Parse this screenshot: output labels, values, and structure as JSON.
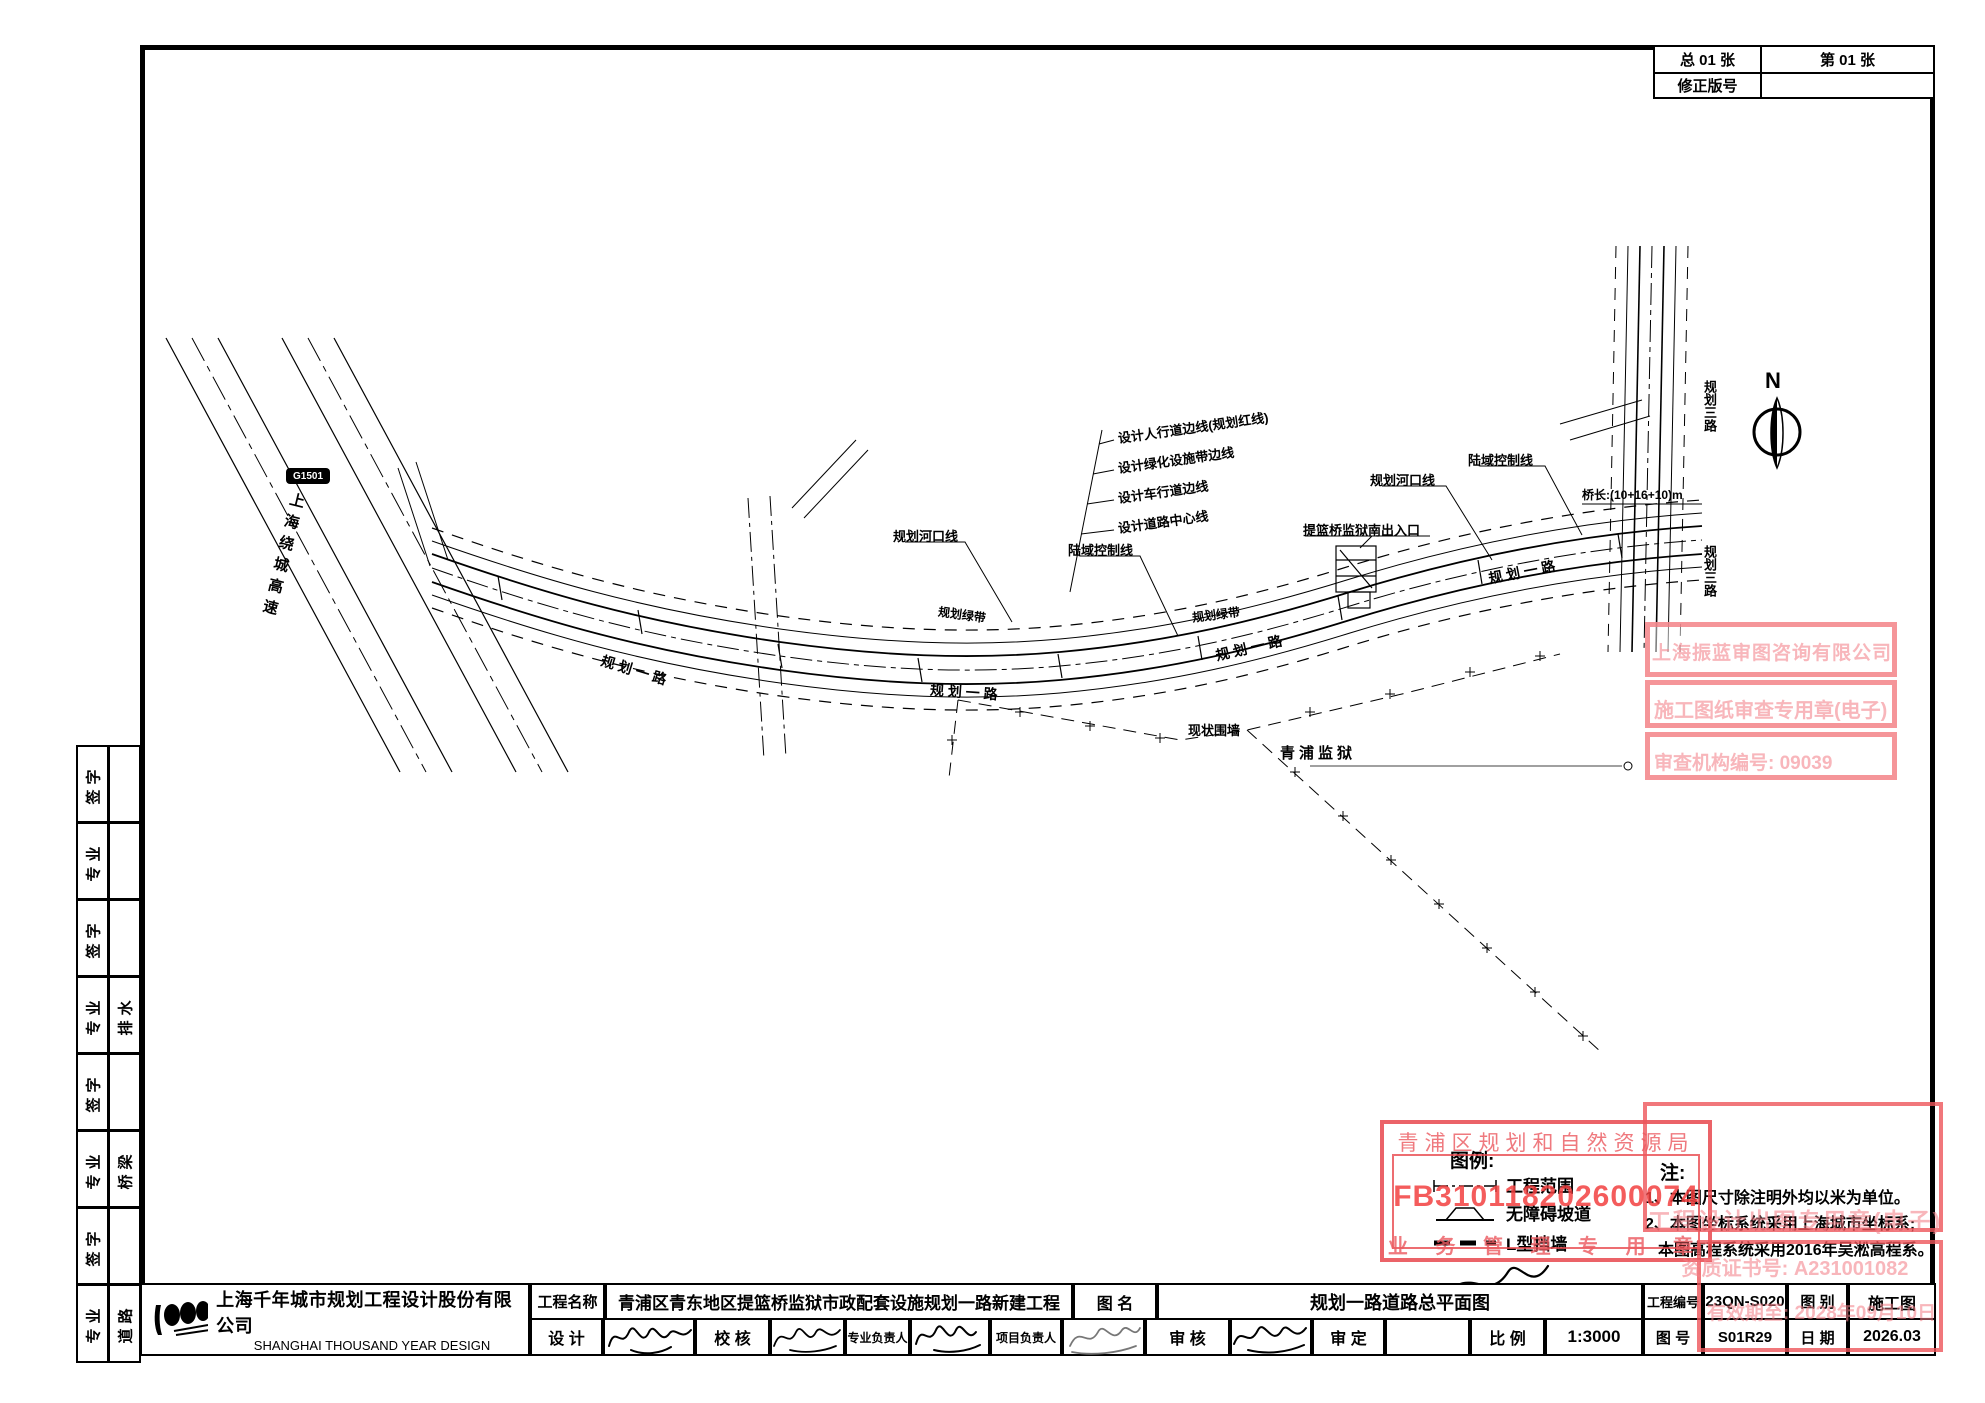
{
  "header": {
    "total_pages": "总 01 张",
    "page_no": "第 01 张",
    "revision_label": "修正版号",
    "revision_value": ""
  },
  "sidebar": {
    "rows": [
      {
        "label": "签字",
        "value": ""
      },
      {
        "label": "专业",
        "value": ""
      },
      {
        "label": "签字",
        "value": ""
      },
      {
        "label": "专业",
        "value": "排水"
      },
      {
        "label": "签字",
        "value": ""
      },
      {
        "label": "专业",
        "value": "桥梁"
      },
      {
        "label": "签字",
        "value": ""
      },
      {
        "label": "专业",
        "value": "道路"
      }
    ]
  },
  "title_block": {
    "company_cn": "上海千年城市规划工程设计股份有限公司",
    "company_en": "SHANGHAI THOUSAND YEAR DESIGN",
    "project_label": "工程名称",
    "project_name": "青浦区青东地区提篮桥监狱市政配套设施规划一路新建工程",
    "drawing_label": "图  名",
    "drawing_name": "规划一路道路总平面图",
    "design_label": "设  计",
    "check_label": "校  核",
    "discipline_lead_label": "专业负责人",
    "project_lead_label": "项目负责人",
    "review_label": "审  核",
    "approve_label": "审  定",
    "scale_label": "比  例",
    "scale_value": "1:3000",
    "project_no_label": "工程编号",
    "project_no": "23QN-S020",
    "category_label": "图  别",
    "category": "施工图",
    "sheet_no_label": "图  号",
    "sheet_no": "S01R29",
    "date_label": "日  期",
    "date": "2026.03"
  },
  "legend": {
    "title": "图例:",
    "items": [
      {
        "label": "工程范围"
      },
      {
        "label": "无障碍坡道"
      },
      {
        "label": "L型挡墙"
      }
    ]
  },
  "notes": {
    "title": "注:",
    "lines": [
      "1、本图尺寸除注明外均以米为单位。",
      "2、本图坐标系统采用上海城市坐标系;",
      "本图高程系统采用2016年吴淞高程系。"
    ]
  },
  "stamps": {
    "planning": {
      "authority": "青浦区规划和自然资源局",
      "number": "FB310118202600074",
      "seal": "业 务 管 理 专 用 章"
    },
    "review": {
      "company": "上海振蓝审图咨询有限公司",
      "seal": "施工图纸审查专用章(电子)",
      "org_no": "审查机构编号: 09039"
    },
    "design": {
      "seal": "工程设计出图专用章(电子)",
      "cert": "资质证书号: A231001082",
      "validity": "有效期至: 2028年09月10日"
    }
  },
  "drawing": {
    "north": "N",
    "g1501_badge": "G1501",
    "g1501_name": "上海绕城高速",
    "callouts": [
      "设计人行道边线(规划红线)",
      "设计绿化设施带边线",
      "设计车行道边线",
      "设计道路中心线"
    ],
    "hekou": "规划河口线",
    "luyu": "陆域控制线",
    "entrance": "提篮桥监狱南出入口",
    "wall": "现状围墙",
    "prison": "青浦监狱",
    "road1": "规 划 一 路",
    "road3": "规划三路",
    "green": "规划绿带",
    "bridge": "桥长:(10+16+10)m"
  },
  "colors": {
    "stamp_red": "#e85c62",
    "seal_pink": "#f3828a",
    "line_black": "#000000"
  }
}
